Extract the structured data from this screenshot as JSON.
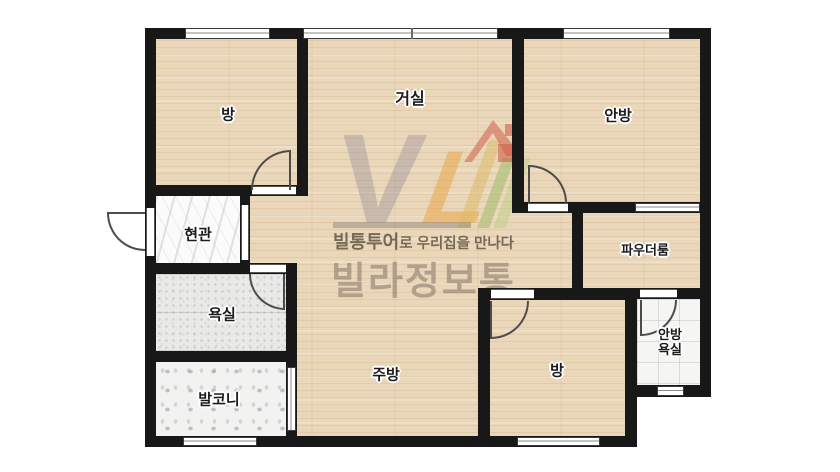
{
  "plan": {
    "rooms": {
      "bedroom1": {
        "label": "방"
      },
      "living": {
        "label": "거실"
      },
      "master_bedroom": {
        "label": "안방"
      },
      "entrance": {
        "label": "현관"
      },
      "bathroom": {
        "label": "욕실"
      },
      "balcony": {
        "label": "발코니"
      },
      "kitchen": {
        "label": "주방"
      },
      "bedroom2": {
        "label": "방"
      },
      "powder_room": {
        "label": "파우더룸"
      },
      "master_bathroom": {
        "label_line1": "안방",
        "label_line2": "욕실"
      }
    }
  },
  "watermark": {
    "logo_v": "V",
    "logo_l": "L",
    "tagline_bold": "빌통투어",
    "tagline_rest": "로 우리집을 만나다",
    "brand": "빌라정보통"
  },
  "colors": {
    "wall": "#181818",
    "wood_floor": "#ead7ba",
    "gray_tile": "#e9e9e7",
    "terrazzo": "#f2f2f0",
    "marble": "#fbfbfb",
    "white_tile": "#f5f5f3",
    "logo_orange": "#e7a548",
    "logo_yellow": "#dcb95f",
    "logo_green": "#a4bc6e",
    "logo_red": "#cf5f4a",
    "watermark_text": "#8a7c6d"
  }
}
